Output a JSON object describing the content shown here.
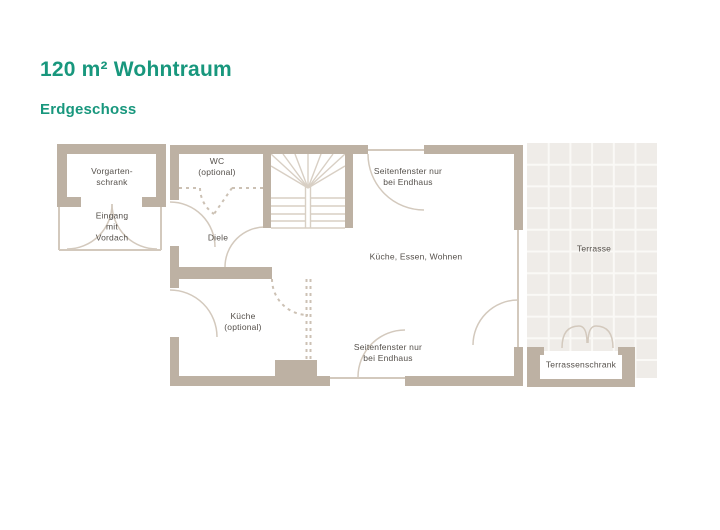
{
  "header": {
    "title": "120 m² Wohntraum",
    "subtitle": "Erdgeschoss"
  },
  "colors": {
    "accent_teal": "#18977D",
    "wall_beige": "#BDB1A3",
    "thin_line_beige": "#D3C9BD",
    "dashed_optional": "#CCC1B4",
    "tile_fill": "#EFECE8",
    "tile_grout": "#FAF9F6",
    "label_text": "#55504B"
  },
  "floorplan": {
    "labels": {
      "vorgartenschrank": {
        "l1": "Vorgarten-",
        "l2": "schrank"
      },
      "eingang": {
        "l1": "Eingang",
        "l2": "mit",
        "l3": "Vordach"
      },
      "wc": {
        "l1": "WC",
        "l2": "(optional)"
      },
      "diele": {
        "text": "Diele"
      },
      "seitenfenster_top": {
        "l1": "Seitenfenster nur",
        "l2": "bei Endhaus"
      },
      "wohnbereich": {
        "text": "Küche, Essen, Wohnen"
      },
      "kueche": {
        "l1": "Küche",
        "l2": "(optional)"
      },
      "seitenfenster_bottom": {
        "l1": "Seitenfenster nur",
        "l2": "bei Endhaus"
      },
      "terrasse": {
        "text": "Terrasse"
      },
      "terrassenschrank": {
        "text": "Terrassenschrank"
      }
    }
  }
}
